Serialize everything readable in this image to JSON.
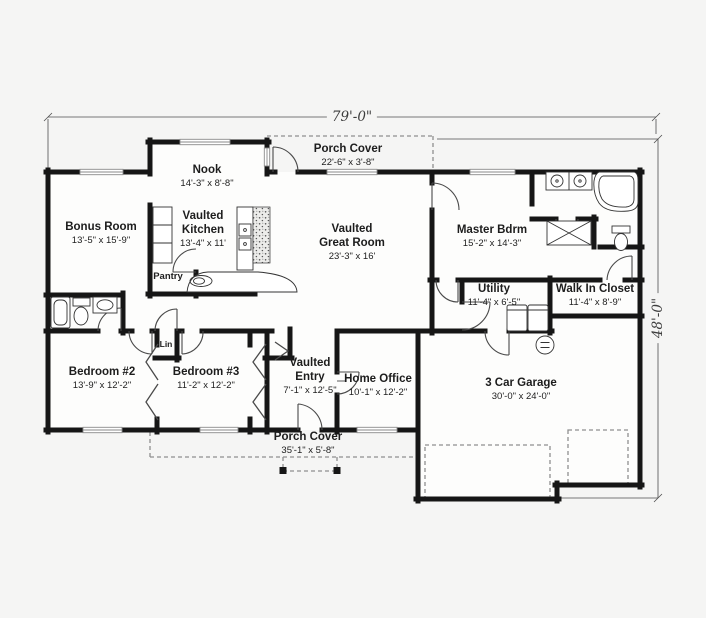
{
  "title": "House floor plan",
  "palette": {
    "background": "#f5f5f4",
    "floor": "#fdfdfc",
    "wall": "#161616",
    "window": "#8a8a8a",
    "dashed_outline": "#8f8f8f",
    "dimension_line": "#4f4f4f",
    "text": "#1d1d1d"
  },
  "overall_dimensions": {
    "width": "79'-0\"",
    "depth": "48'-0\""
  },
  "rooms": [
    {
      "id": "nook",
      "name_lines": [
        "Nook"
      ],
      "size": "14'-3\" x 8'-8\"",
      "x": 207,
      "y": 164,
      "style": "normal"
    },
    {
      "id": "porch-cover-top",
      "name_lines": [
        "Porch Cover"
      ],
      "size": "22'-6\" x 3'-8\"",
      "x": 348,
      "y": 143,
      "style": "normal"
    },
    {
      "id": "bonus-room",
      "name_lines": [
        "Bonus Room"
      ],
      "size": "13'-5\" x 15'-9\"",
      "x": 101,
      "y": 221,
      "style": "normal"
    },
    {
      "id": "vaulted-kitchen",
      "name_lines": [
        "Vaulted",
        "Kitchen"
      ],
      "size": "13'-4\" x 11'",
      "x": 203,
      "y": 210,
      "style": "normal"
    },
    {
      "id": "pantry",
      "name_lines": [
        "Pantry"
      ],
      "size": "",
      "x": 168,
      "y": 271,
      "style": "small"
    },
    {
      "id": "vaulted-great-room",
      "name_lines": [
        "Vaulted",
        "Great Room"
      ],
      "size": "23'-3\" x 16'",
      "x": 352,
      "y": 223,
      "style": "normal"
    },
    {
      "id": "master-bdrm",
      "name_lines": [
        "Master Bdrm"
      ],
      "size": "15'-2\" x 14'-3\"",
      "x": 492,
      "y": 224,
      "style": "normal"
    },
    {
      "id": "utility",
      "name_lines": [
        "Utility"
      ],
      "size": "11'-4\" x 6'-5\"",
      "x": 494,
      "y": 283,
      "style": "normal"
    },
    {
      "id": "walk-in-closet",
      "name_lines": [
        "Walk In Closet"
      ],
      "size": "11'-4\" x 8'-9\"",
      "x": 595,
      "y": 283,
      "style": "normal"
    },
    {
      "id": "bedroom-2",
      "name_lines": [
        "Bedroom #2"
      ],
      "size": "13'-9\" x 12'-2\"",
      "x": 102,
      "y": 366,
      "style": "normal"
    },
    {
      "id": "bedroom-3",
      "name_lines": [
        "Bedroom #3"
      ],
      "size": "11'-2\" x 12'-2\"",
      "x": 206,
      "y": 366,
      "style": "normal"
    },
    {
      "id": "lin",
      "name_lines": [
        "Lin"
      ],
      "size": "",
      "x": 166,
      "y": 339,
      "style": "tiny"
    },
    {
      "id": "vaulted-entry",
      "name_lines": [
        "Vaulted",
        "Entry"
      ],
      "size": "7'-1\" x 12'-5\"",
      "x": 310,
      "y": 357,
      "style": "normal"
    },
    {
      "id": "home-office",
      "name_lines": [
        "Home Office"
      ],
      "size": "10'-1\" x 12'-2\"",
      "x": 378,
      "y": 373,
      "style": "normal"
    },
    {
      "id": "garage",
      "name_lines": [
        "3 Car Garage"
      ],
      "size": "30'-0\" x 24'-0\"",
      "x": 521,
      "y": 377,
      "style": "normal"
    },
    {
      "id": "porch-cover-bottom",
      "name_lines": [
        "Porch Cover"
      ],
      "size": "35'-1\" x 5'-8\"",
      "x": 308,
      "y": 431,
      "style": "normal"
    }
  ]
}
